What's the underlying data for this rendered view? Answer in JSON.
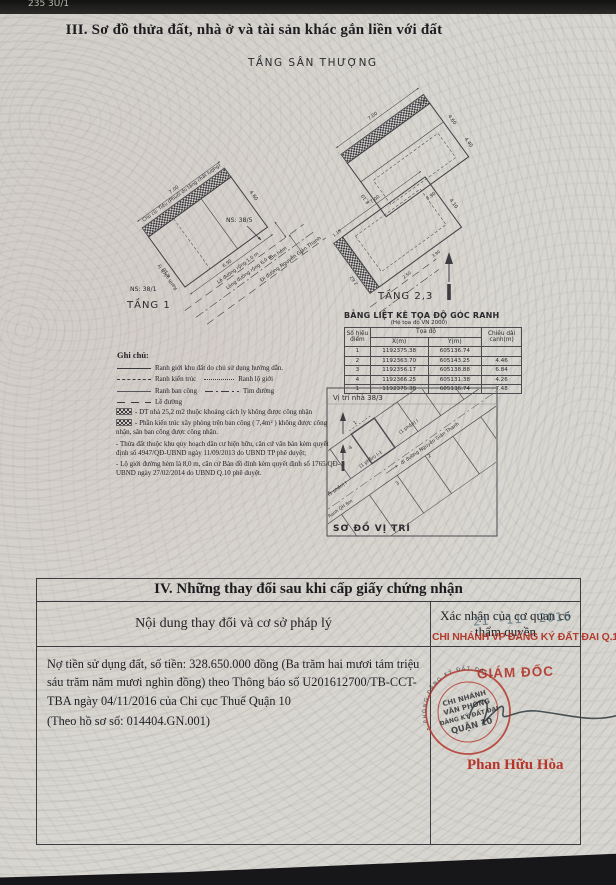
{
  "page": {
    "top_edge_text": "235 3U/1",
    "section3_title": "III. Sơ đồ thửa đất, nhà ở và tài sản khác gắn liền với đất"
  },
  "diagram": {
    "roof_label": "TẦNG SÂN THƯỢNG",
    "floor1_label": "TẦNG 1",
    "floor23_label": "TẦNG 2,3",
    "ns_right": "NS: 38/5",
    "ns_left": "NS: 38/1",
    "owner_note": "Chủ cũ: Tiêu (Phuổi đo tầng chất lượng)",
    "ranh_cach_ly": "Ranh cách ly",
    "le_duong": "Lề đường rộng 1,0 m",
    "long_duong": "Lòng đường rộng 6,0 m",
    "tim_hem": "tim hẻm",
    "street": "Đi đường Nguyễn Giản Thanh",
    "dims": {
      "roof_top": "7.00",
      "roof_right1": "4.60",
      "roof_right2": "4.40",
      "roof_left": "8.10",
      "roof_bottom": "3.90",
      "roof_small": "0.80",
      "f1_top": "7.00",
      "f1_right": "4.60",
      "f1_bottom": "6.90",
      "f1_left": "4.10",
      "f23_top": "7.00",
      "f23_right": "4.10",
      "f23_left": "2.62",
      "f23_b1": "2.50",
      "f23_b2": "3.90",
      "f23_small": "1.10"
    }
  },
  "coord_table": {
    "title": "BẢNG LIỆT KÊ TỌA ĐỘ GÓC RANH",
    "subtitle": "(Hệ tọa độ VN 2000)",
    "col_point": "Số hiệu điểm",
    "col_coord": "Tọa độ",
    "col_x": "X(m)",
    "col_y": "Y(m)",
    "col_len": "Chiều dài cạnh(m)",
    "rows": [
      [
        "1",
        "1192375.38",
        "605136.74",
        ""
      ],
      [
        "2",
        "1192363.70",
        "605143.25",
        "4.46"
      ],
      [
        "3",
        "1192356.17",
        "605138.88",
        "6.84"
      ],
      [
        "4",
        "1192366.25",
        "605131.38",
        "4.26"
      ],
      [
        "1",
        "1192375.38",
        "605136.74",
        "7.48"
      ]
    ]
  },
  "legend": {
    "title": "Ghi chú:",
    "item1": "Ranh giới khu đất do chủ sử dụng hướng dẫn.",
    "item2a": "Ranh kiến trúc",
    "item2b": "Ranh lộ giới",
    "item3a": "Ranh ban công",
    "item3b": "Tim đường",
    "item4": "Lề đường"
  },
  "notes": {
    "n1": "- DT nhà 25,2 m2 thuộc khoảng cách ly không được công nhận",
    "n2": "- Phần kiến trúc xây phòng trên ban công ( 7,4m² ) không được công nhận, sân ban công được công nhận.",
    "n3": "- Thửa đất thuộc khu quy hoạch dân cư hiện hữu, căn cứ văn bản kèm quyết định số 4947/QĐ-UBND ngày 11/09/2013 do UBND TP phê duyệt;",
    "n4": "- Lộ giới đường hẻm là 8,0 m, căn cứ Bản đồ đính kèm quyết định số 1765/QĐ-UBND ngày 27/02/2014 do UBND Q.10 phê duyệt."
  },
  "location": {
    "title": "Vị trí nhà 38/3",
    "caption": "SƠ ĐỒ VỊ TRÍ",
    "parcel1": "(1 phần) I",
    "parcel2": "(1 phần) I-1",
    "parcel3": "(1 phần) I",
    "ranh_qh": "Ranh QH 8m",
    "street": "đi đường Nguyễn Giản Thanh",
    "pt1": "1",
    "pt2": "2",
    "pt3": "3",
    "pt4": "4"
  },
  "section4": {
    "title": "IV. Những thay đổi sau khi cấp giấy chứng nhận",
    "col_left": "Nội dung thay đổi và cơ sở pháp lý",
    "col_right": "Xác nhận của cơ quan có thẩm quyền",
    "content": "Nợ tiền sử dụng đất, số tiền: 328.650.000 đồng (Ba trăm hai mươi tám triệu sáu trăm năm mươi nghìn đồng) theo Thông báo số U201612700/TB-CCT-TBA ngày 04/11/2016 của Chi cục Thuế Quận 10",
    "dossier": "(Theo hồ sơ số: 014404.GN.001)",
    "stamp": {
      "date": "21 -11- 2016",
      "office": "CHI NHÁNH VP ĐĂNG KÝ ĐẤT ĐAI Q.10",
      "role": "GIÁM ĐỐC",
      "name": "Phan Hữu Hòa",
      "seal_l1": "CHI NHÁNH",
      "seal_l2": "VĂN PHÒNG",
      "seal_l3": "ĐĂNG KÝ ĐẤT ĐAI",
      "seal_l4": "QUẬN 10",
      "seal_ring": "• PHÒNG ĐĂNG KÝ ĐẤT ĐAI •"
    }
  },
  "colors": {
    "paper": "#d8d6d0",
    "ink": "#26262a",
    "stamp_red": "#b02c20",
    "date_ink": "#53707a"
  }
}
